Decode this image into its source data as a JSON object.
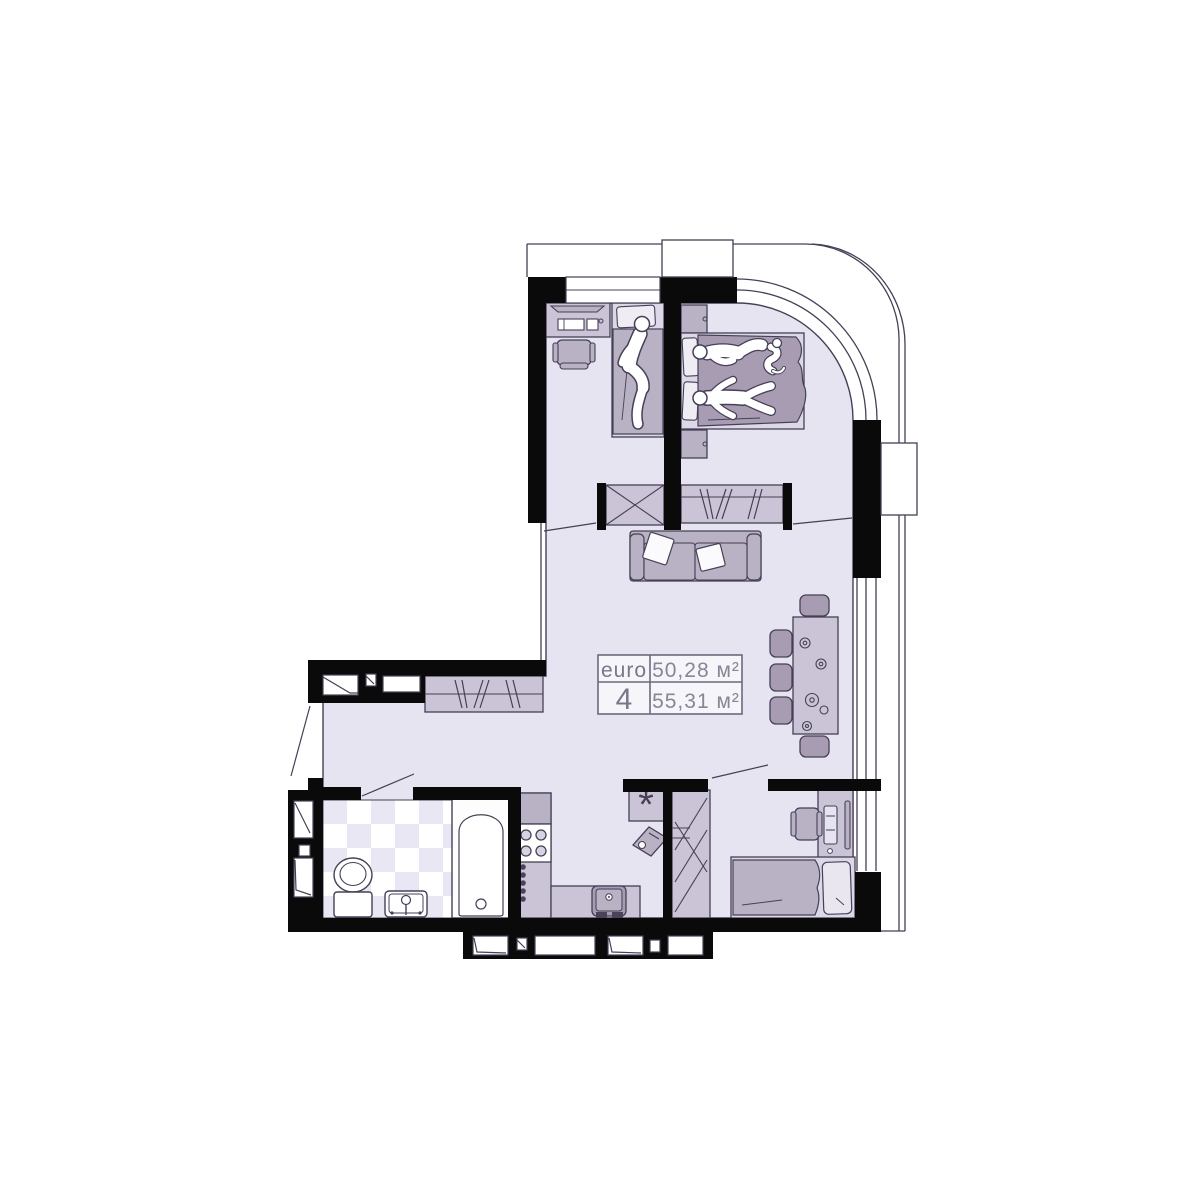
{
  "plan": {
    "title": "apartment-floor-plan",
    "label": {
      "type_label": "euro",
      "rooms_count": "4",
      "living_area": "50,28 м²",
      "total_area": "55,31 м²"
    },
    "utility": {
      "symbol": "*"
    },
    "colors": {
      "wall": "#0a0a0a",
      "floor": "#e6e4f0",
      "tile": "#e9e7f3",
      "furniture_light": "#cbc4d6",
      "furniture_mid": "#b9b1c4",
      "furniture_dark": "#a89cb3",
      "bed_base": "#dcd8e7",
      "outline": "#454056",
      "label_border": "#6e6880",
      "label_text": "#7c7589",
      "white": "#ffffff"
    }
  }
}
